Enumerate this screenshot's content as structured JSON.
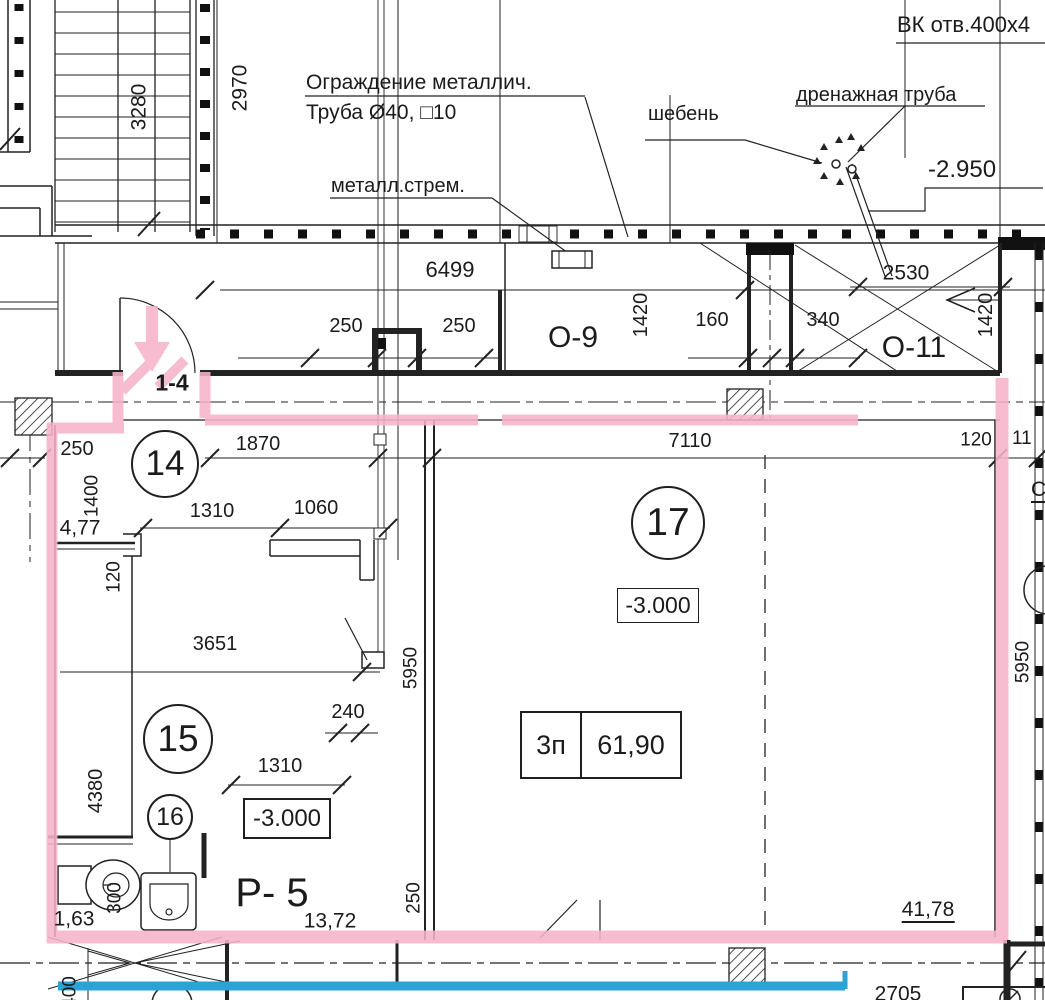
{
  "drawing": {
    "colors": {
      "highlight_pink": "#f6b3c9",
      "highlight_blue": "#2ba3d6",
      "line": "#222222"
    },
    "labels": {
      "vk": "ВК отв.400x4",
      "fence1": "Ограждение металлич.",
      "fence2": "Труба Ø40, □10",
      "ladder": "металл.стрем.",
      "gravel": "шебень",
      "drain": "дренажная труба",
      "elev_top": "-2.950",
      "o9": "О-9",
      "o11": "О-11",
      "door_mark": "1-4",
      "p5": "Р- 5",
      "note_cut": "С",
      "room14": "14",
      "room15": "15",
      "room16": "16",
      "room17": "17",
      "elev15": "-3.000",
      "elev17": "-3.000",
      "area_type": "3п",
      "area_value": "61,90",
      "d3280": "3280",
      "d2970": "2970",
      "d6499": "6499",
      "d250a": "250",
      "d250b": "250",
      "d1420a": "1420",
      "d160": "160",
      "d340": "340",
      "d2530": "2530",
      "d1420b": "1420",
      "d250c": "250",
      "d1870": "1870",
      "d7110": "7110",
      "d120a": "120",
      "d11": "11",
      "d1400": "1400",
      "d477": "4,77",
      "d1310a": "1310",
      "d1060": "1060",
      "d120b": "120",
      "d3651": "3651",
      "d4380": "4380",
      "d240": "240",
      "d1310b": "1310",
      "d5950a": "5950",
      "d5950b": "5950",
      "d250d": "250",
      "d300": "300",
      "d163": "1,63",
      "d1372": "13,72",
      "d4178": "41,78",
      "d2705": "2705",
      "d400": "400"
    }
  }
}
